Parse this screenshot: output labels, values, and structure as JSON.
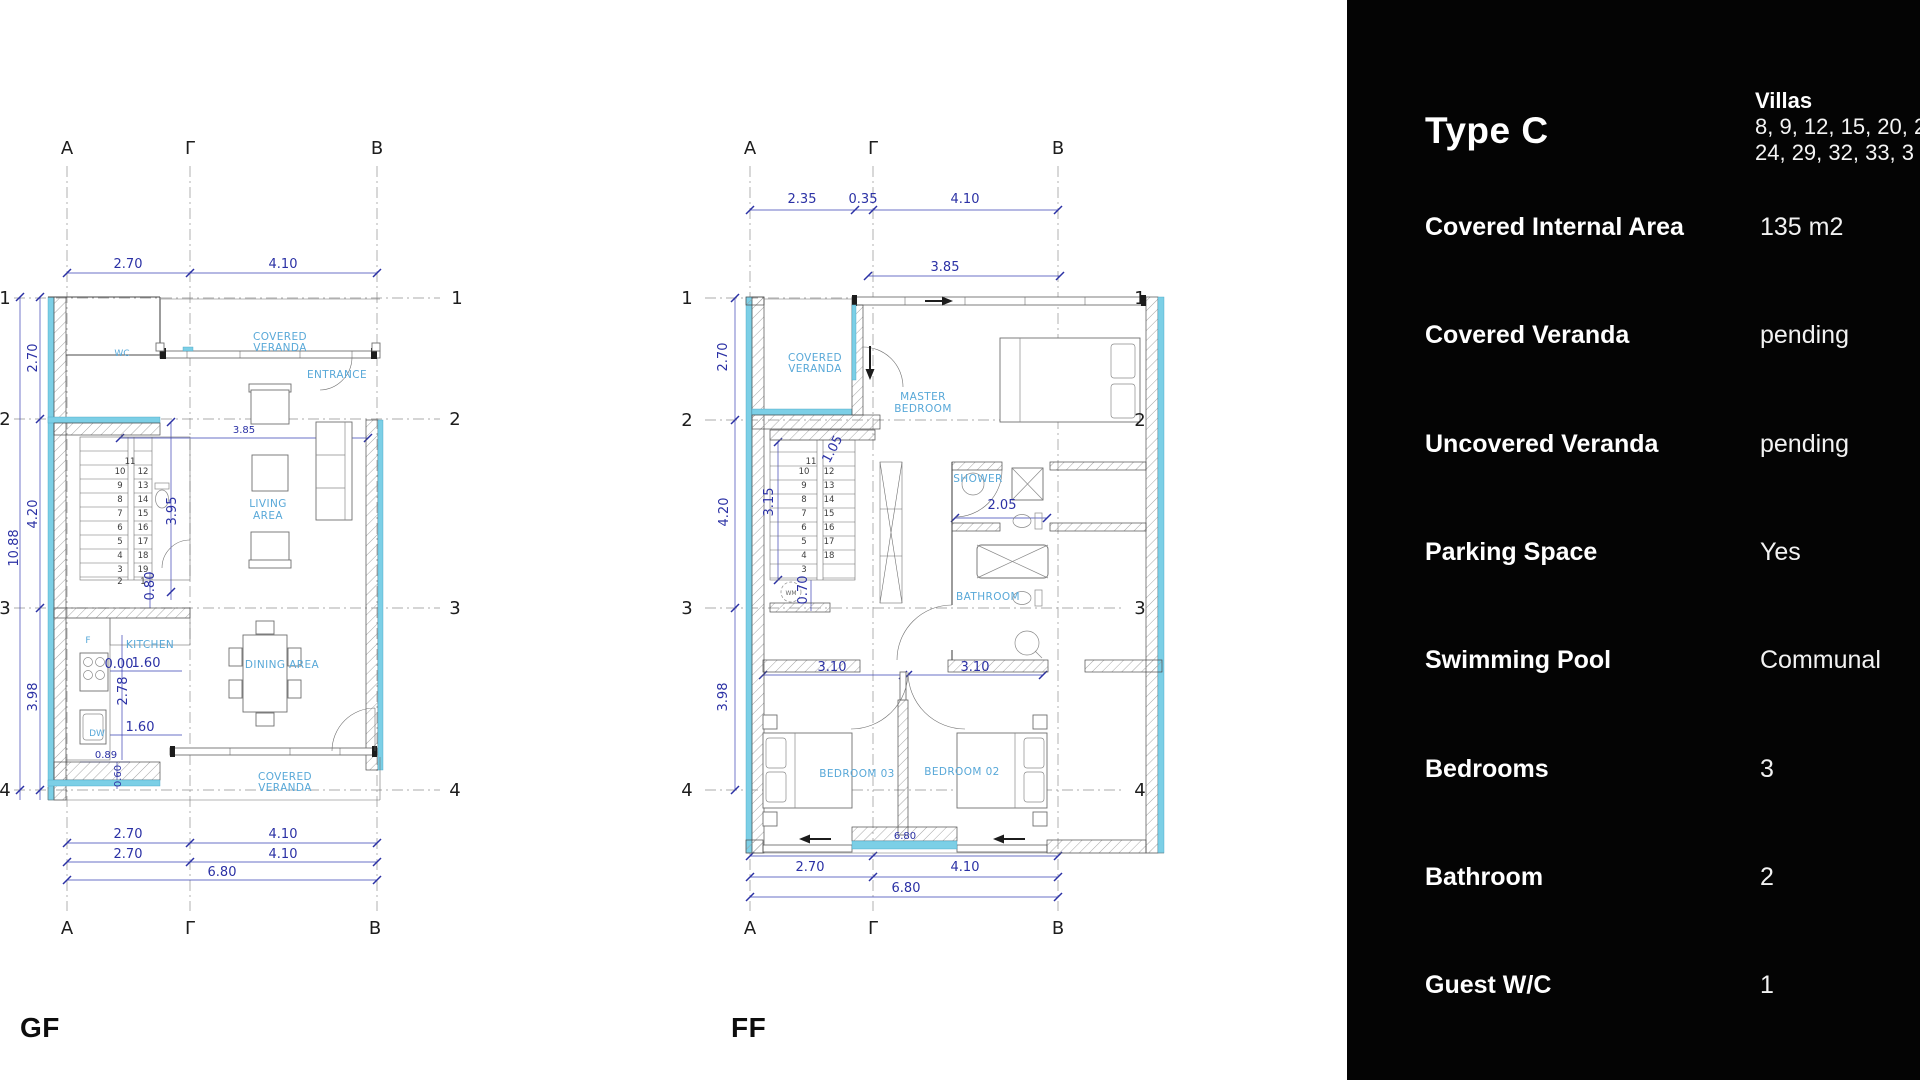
{
  "colors": {
    "wall_accent": "#7ccfe6",
    "dimension_text": "#2b31a5",
    "room_label": "#58a8d8",
    "panel_bg": "#040404",
    "panel_text": "#ffffff"
  },
  "panel": {
    "title": "Type C",
    "villas": {
      "label": "Villas",
      "lines": [
        "8, 9, 12, 15, 20, 2",
        "24, 29, 32, 33, 3"
      ]
    },
    "rows": [
      {
        "label": "Covered Internal Area",
        "value": "135 m2"
      },
      {
        "label": "Covered Veranda",
        "value": "pending"
      },
      {
        "label": "Uncovered Veranda",
        "value": "pending"
      },
      {
        "label": "Parking Space",
        "value": "Yes"
      },
      {
        "label": "Swimming Pool",
        "value": "Communal"
      },
      {
        "label": "Bedrooms",
        "value": "3"
      },
      {
        "label": "Bathroom",
        "value": "2"
      },
      {
        "label": "Guest W/C",
        "value": "1"
      }
    ]
  },
  "plans": {
    "gf": {
      "label": "GF",
      "texts": [
        {
          "t": "A",
          "x": 67,
          "y": 64,
          "c": "bub"
        },
        {
          "t": "Γ",
          "x": 190,
          "y": 64,
          "c": "bub"
        },
        {
          "t": "B",
          "x": 377,
          "y": 64,
          "c": "bub"
        },
        {
          "t": "A",
          "x": 67,
          "y": 844,
          "c": "bub"
        },
        {
          "t": "Γ",
          "x": 190,
          "y": 844,
          "c": "bub"
        },
        {
          "t": "B",
          "x": 375,
          "y": 844,
          "c": "bub"
        },
        {
          "t": "1",
          "x": 457,
          "y": 214,
          "c": "bub"
        },
        {
          "t": "2",
          "x": 455,
          "y": 335,
          "c": "bub"
        },
        {
          "t": "3",
          "x": 455,
          "y": 524,
          "c": "bub"
        },
        {
          "t": "4",
          "x": 455,
          "y": 706,
          "c": "bub"
        },
        {
          "t": "1",
          "x": 5,
          "y": 214,
          "c": "bub"
        },
        {
          "t": "2",
          "x": 5,
          "y": 335,
          "c": "bub"
        },
        {
          "t": "3",
          "x": 5,
          "y": 524,
          "c": "bub"
        },
        {
          "t": "4",
          "x": 5,
          "y": 706,
          "c": "bub"
        },
        {
          "t": "2.70",
          "x": 128,
          "y": 178,
          "c": "dim"
        },
        {
          "t": "4.10",
          "x": 283,
          "y": 178,
          "c": "dim"
        },
        {
          "t": "2.70",
          "x": 37,
          "y": 268,
          "c": "dim",
          "r": -90
        },
        {
          "t": "4.20",
          "x": 37,
          "y": 424,
          "c": "dim",
          "r": -90
        },
        {
          "t": "3.98",
          "x": 37,
          "y": 607,
          "c": "dim",
          "r": -90
        },
        {
          "t": "10.88",
          "x": 18,
          "y": 458,
          "c": "dim",
          "r": -90
        },
        {
          "t": "3.85",
          "x": 244,
          "y": 343,
          "c": "dimS"
        },
        {
          "t": "3.95",
          "x": 176,
          "y": 421,
          "c": "dim",
          "r": -90
        },
        {
          "t": "0.80",
          "x": 154,
          "y": 496,
          "c": "dim",
          "r": -90
        },
        {
          "t": "0.00",
          "x": 119,
          "y": 578,
          "c": "dim"
        },
        {
          "t": "1.60",
          "x": 146,
          "y": 577,
          "c": "dim"
        },
        {
          "t": "2.78",
          "x": 127,
          "y": 601,
          "c": "dim",
          "r": -90
        },
        {
          "t": "1.60",
          "x": 140,
          "y": 641,
          "c": "dim"
        },
        {
          "t": "0.89",
          "x": 106,
          "y": 668,
          "c": "dimS"
        },
        {
          "t": "0.60",
          "x": 121,
          "y": 686,
          "c": "dimS",
          "r": -90
        },
        {
          "t": "2.70",
          "x": 128,
          "y": 748,
          "c": "dim"
        },
        {
          "t": "4.10",
          "x": 283,
          "y": 748,
          "c": "dim"
        },
        {
          "t": "2.70",
          "x": 128,
          "y": 768,
          "c": "dim"
        },
        {
          "t": "4.10",
          "x": 283,
          "y": 768,
          "c": "dim"
        },
        {
          "t": "6.80",
          "x": 222,
          "y": 786,
          "c": "dim"
        },
        {
          "t": "WC",
          "x": 122,
          "y": 266,
          "c": "roomS"
        },
        {
          "t": "COVERED",
          "x": 280,
          "y": 250,
          "c": "room"
        },
        {
          "t": "VERANDA",
          "x": 280,
          "y": 261,
          "c": "room"
        },
        {
          "t": "ENTRANCE",
          "x": 337,
          "y": 288,
          "c": "room"
        },
        {
          "t": "LIVING",
          "x": 268,
          "y": 417,
          "c": "room"
        },
        {
          "t": "AREA",
          "x": 268,
          "y": 429,
          "c": "room"
        },
        {
          "t": "KITCHEN",
          "x": 150,
          "y": 558,
          "c": "room"
        },
        {
          "t": "F",
          "x": 88,
          "y": 553,
          "c": "roomS"
        },
        {
          "t": "DW",
          "x": 97,
          "y": 646,
          "c": "roomS"
        },
        {
          "t": "DINING AREA",
          "x": 282,
          "y": 578,
          "c": "room"
        },
        {
          "t": "COVERED",
          "x": 285,
          "y": 690,
          "c": "room"
        },
        {
          "t": "VERANDA",
          "x": 285,
          "y": 701,
          "c": "room"
        },
        {
          "t": "11",
          "x": 130,
          "y": 374,
          "c": "stair"
        },
        {
          "t": "10",
          "x": 120,
          "y": 384,
          "c": "stair"
        },
        {
          "t": "12",
          "x": 143,
          "y": 384,
          "c": "stair"
        },
        {
          "t": "9",
          "x": 120,
          "y": 398,
          "c": "stair"
        },
        {
          "t": "13",
          "x": 143,
          "y": 398,
          "c": "stair"
        },
        {
          "t": "8",
          "x": 120,
          "y": 412,
          "c": "stair"
        },
        {
          "t": "14",
          "x": 143,
          "y": 412,
          "c": "stair"
        },
        {
          "t": "7",
          "x": 120,
          "y": 426,
          "c": "stair"
        },
        {
          "t": "15",
          "x": 143,
          "y": 426,
          "c": "stair"
        },
        {
          "t": "6",
          "x": 120,
          "y": 440,
          "c": "stair"
        },
        {
          "t": "16",
          "x": 143,
          "y": 440,
          "c": "stair"
        },
        {
          "t": "5",
          "x": 120,
          "y": 454,
          "c": "stair"
        },
        {
          "t": "17",
          "x": 143,
          "y": 454,
          "c": "stair"
        },
        {
          "t": "4",
          "x": 120,
          "y": 468,
          "c": "stair"
        },
        {
          "t": "18",
          "x": 143,
          "y": 468,
          "c": "stair"
        },
        {
          "t": "3",
          "x": 120,
          "y": 482,
          "c": "stair"
        },
        {
          "t": "19",
          "x": 143,
          "y": 482,
          "c": "stair"
        },
        {
          "t": "2",
          "x": 120,
          "y": 494,
          "c": "stair"
        },
        {
          "t": "1",
          "x": 143,
          "y": 494,
          "c": "stair"
        }
      ]
    },
    "ff": {
      "label": "FF",
      "texts": [
        {
          "t": "A",
          "x": 205,
          "y": 64,
          "c": "bub"
        },
        {
          "t": "Γ",
          "x": 328,
          "y": 64,
          "c": "bub"
        },
        {
          "t": "B",
          "x": 513,
          "y": 64,
          "c": "bub"
        },
        {
          "t": "A",
          "x": 205,
          "y": 844,
          "c": "bub"
        },
        {
          "t": "Γ",
          "x": 328,
          "y": 844,
          "c": "bub"
        },
        {
          "t": "B",
          "x": 513,
          "y": 844,
          "c": "bub"
        },
        {
          "t": "1",
          "x": 142,
          "y": 214,
          "c": "bub"
        },
        {
          "t": "2",
          "x": 142,
          "y": 336,
          "c": "bub"
        },
        {
          "t": "3",
          "x": 142,
          "y": 524,
          "c": "bub"
        },
        {
          "t": "4",
          "x": 142,
          "y": 706,
          "c": "bub"
        },
        {
          "t": "1",
          "x": 595,
          "y": 214,
          "c": "bub"
        },
        {
          "t": "2",
          "x": 595,
          "y": 336,
          "c": "bub"
        },
        {
          "t": "3",
          "x": 595,
          "y": 524,
          "c": "bub"
        },
        {
          "t": "4",
          "x": 595,
          "y": 706,
          "c": "bub"
        },
        {
          "t": "2.35",
          "x": 257,
          "y": 113,
          "c": "dim"
        },
        {
          "t": "0.35",
          "x": 318,
          "y": 113,
          "c": "dim"
        },
        {
          "t": "4.10",
          "x": 420,
          "y": 113,
          "c": "dim"
        },
        {
          "t": "3.85",
          "x": 400,
          "y": 181,
          "c": "dim"
        },
        {
          "t": "2.70",
          "x": 182,
          "y": 267,
          "c": "dim",
          "r": -90
        },
        {
          "t": "4.20",
          "x": 183,
          "y": 422,
          "c": "dim",
          "r": -90
        },
        {
          "t": "3.98",
          "x": 182,
          "y": 607,
          "c": "dim",
          "r": -90
        },
        {
          "t": "3.15",
          "x": 228,
          "y": 412,
          "c": "dim",
          "r": -90
        },
        {
          "t": "1.05",
          "x": 291,
          "y": 361,
          "c": "dim",
          "r": -62
        },
        {
          "t": "0.70",
          "x": 262,
          "y": 500,
          "c": "dim",
          "r": -90
        },
        {
          "t": "2.05",
          "x": 457,
          "y": 419,
          "c": "dim"
        },
        {
          "t": "3.10",
          "x": 287,
          "y": 581,
          "c": "dim"
        },
        {
          "t": "3.10",
          "x": 430,
          "y": 581,
          "c": "dim"
        },
        {
          "t": "6.80",
          "x": 360,
          "y": 749,
          "c": "dimS"
        },
        {
          "t": "2.70",
          "x": 265,
          "y": 781,
          "c": "dim"
        },
        {
          "t": "4.10",
          "x": 420,
          "y": 781,
          "c": "dim"
        },
        {
          "t": "6.80",
          "x": 361,
          "y": 802,
          "c": "dim"
        },
        {
          "t": "COVERED",
          "x": 270,
          "y": 271,
          "c": "room"
        },
        {
          "t": "VERANDA",
          "x": 270,
          "y": 282,
          "c": "room"
        },
        {
          "t": "MASTER",
          "x": 378,
          "y": 310,
          "c": "room"
        },
        {
          "t": "BEDROOM",
          "x": 378,
          "y": 322,
          "c": "room"
        },
        {
          "t": "SHOWER",
          "x": 433,
          "y": 392,
          "c": "room"
        },
        {
          "t": "BATHROOM",
          "x": 443,
          "y": 510,
          "c": "room"
        },
        {
          "t": "BEDROOM 03",
          "x": 312,
          "y": 687,
          "c": "room"
        },
        {
          "t": "BEDROOM 02",
          "x": 417,
          "y": 685,
          "c": "room"
        },
        {
          "t": "WM",
          "x": 246,
          "y": 505,
          "c": "tiny"
        },
        {
          "t": "11",
          "x": 266,
          "y": 374,
          "c": "stair"
        },
        {
          "t": "10",
          "x": 259,
          "y": 384,
          "c": "stair"
        },
        {
          "t": "12",
          "x": 284,
          "y": 384,
          "c": "stair"
        },
        {
          "t": "9",
          "x": 259,
          "y": 398,
          "c": "stair"
        },
        {
          "t": "13",
          "x": 284,
          "y": 398,
          "c": "stair"
        },
        {
          "t": "8",
          "x": 259,
          "y": 412,
          "c": "stair"
        },
        {
          "t": "14",
          "x": 284,
          "y": 412,
          "c": "stair"
        },
        {
          "t": "7",
          "x": 259,
          "y": 426,
          "c": "stair"
        },
        {
          "t": "15",
          "x": 284,
          "y": 426,
          "c": "stair"
        },
        {
          "t": "6",
          "x": 259,
          "y": 440,
          "c": "stair"
        },
        {
          "t": "16",
          "x": 284,
          "y": 440,
          "c": "stair"
        },
        {
          "t": "5",
          "x": 259,
          "y": 454,
          "c": "stair"
        },
        {
          "t": "17",
          "x": 284,
          "y": 454,
          "c": "stair"
        },
        {
          "t": "4",
          "x": 259,
          "y": 468,
          "c": "stair"
        },
        {
          "t": "18",
          "x": 284,
          "y": 468,
          "c": "stair"
        },
        {
          "t": "3",
          "x": 259,
          "y": 482,
          "c": "stair"
        }
      ]
    }
  }
}
